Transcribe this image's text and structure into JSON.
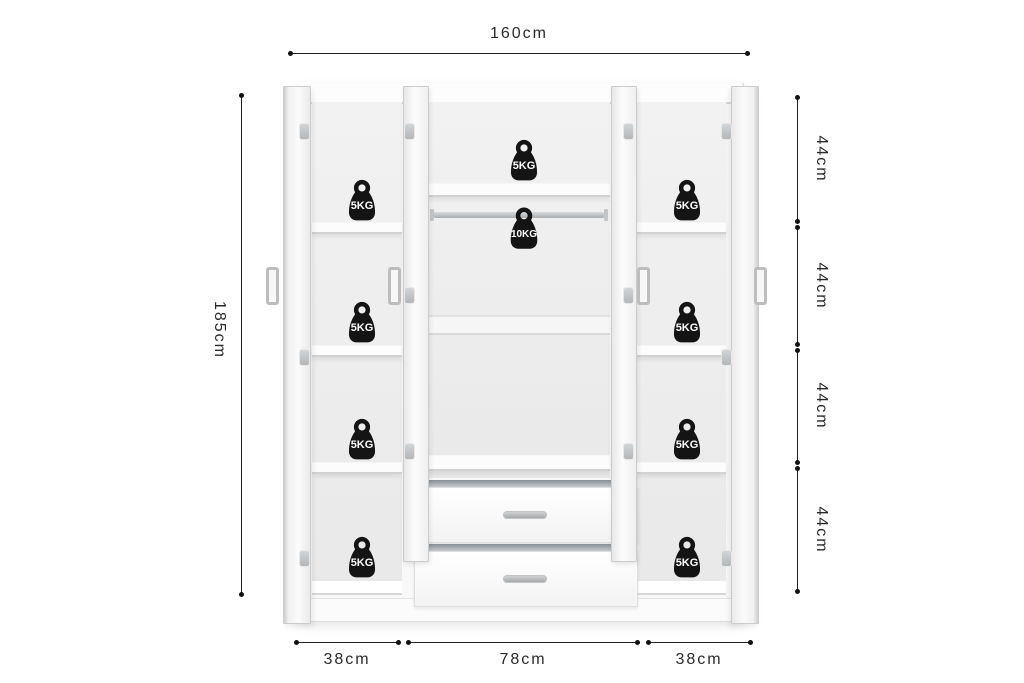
{
  "product_diagram": {
    "dimensions": {
      "total_width": "160cm",
      "total_height": "185cm",
      "section_heights": [
        "44cm",
        "44cm",
        "44cm",
        "44cm"
      ],
      "section_widths": [
        "38cm",
        "78cm",
        "38cm"
      ]
    },
    "capacity_labels": {
      "left_shelves": [
        "5KG",
        "5KG",
        "5KG",
        "5KG"
      ],
      "top_shelf": "5KG",
      "hanging_rail": "10KG",
      "right_shelves": [
        "5KG",
        "5KG",
        "5KG",
        "5KG"
      ]
    },
    "icons": {
      "weight": "kettlebell-weight-icon"
    },
    "colors": {
      "dimension_line": "#1f1f1f",
      "label_text": "#2a2a2a",
      "weight_fill": "#141414",
      "weight_text": "#ffffff",
      "furniture_border": "#d6d6d6",
      "interior_bg": "#eeeeee",
      "metal": "#b9bec2",
      "background": "#ffffff"
    }
  }
}
